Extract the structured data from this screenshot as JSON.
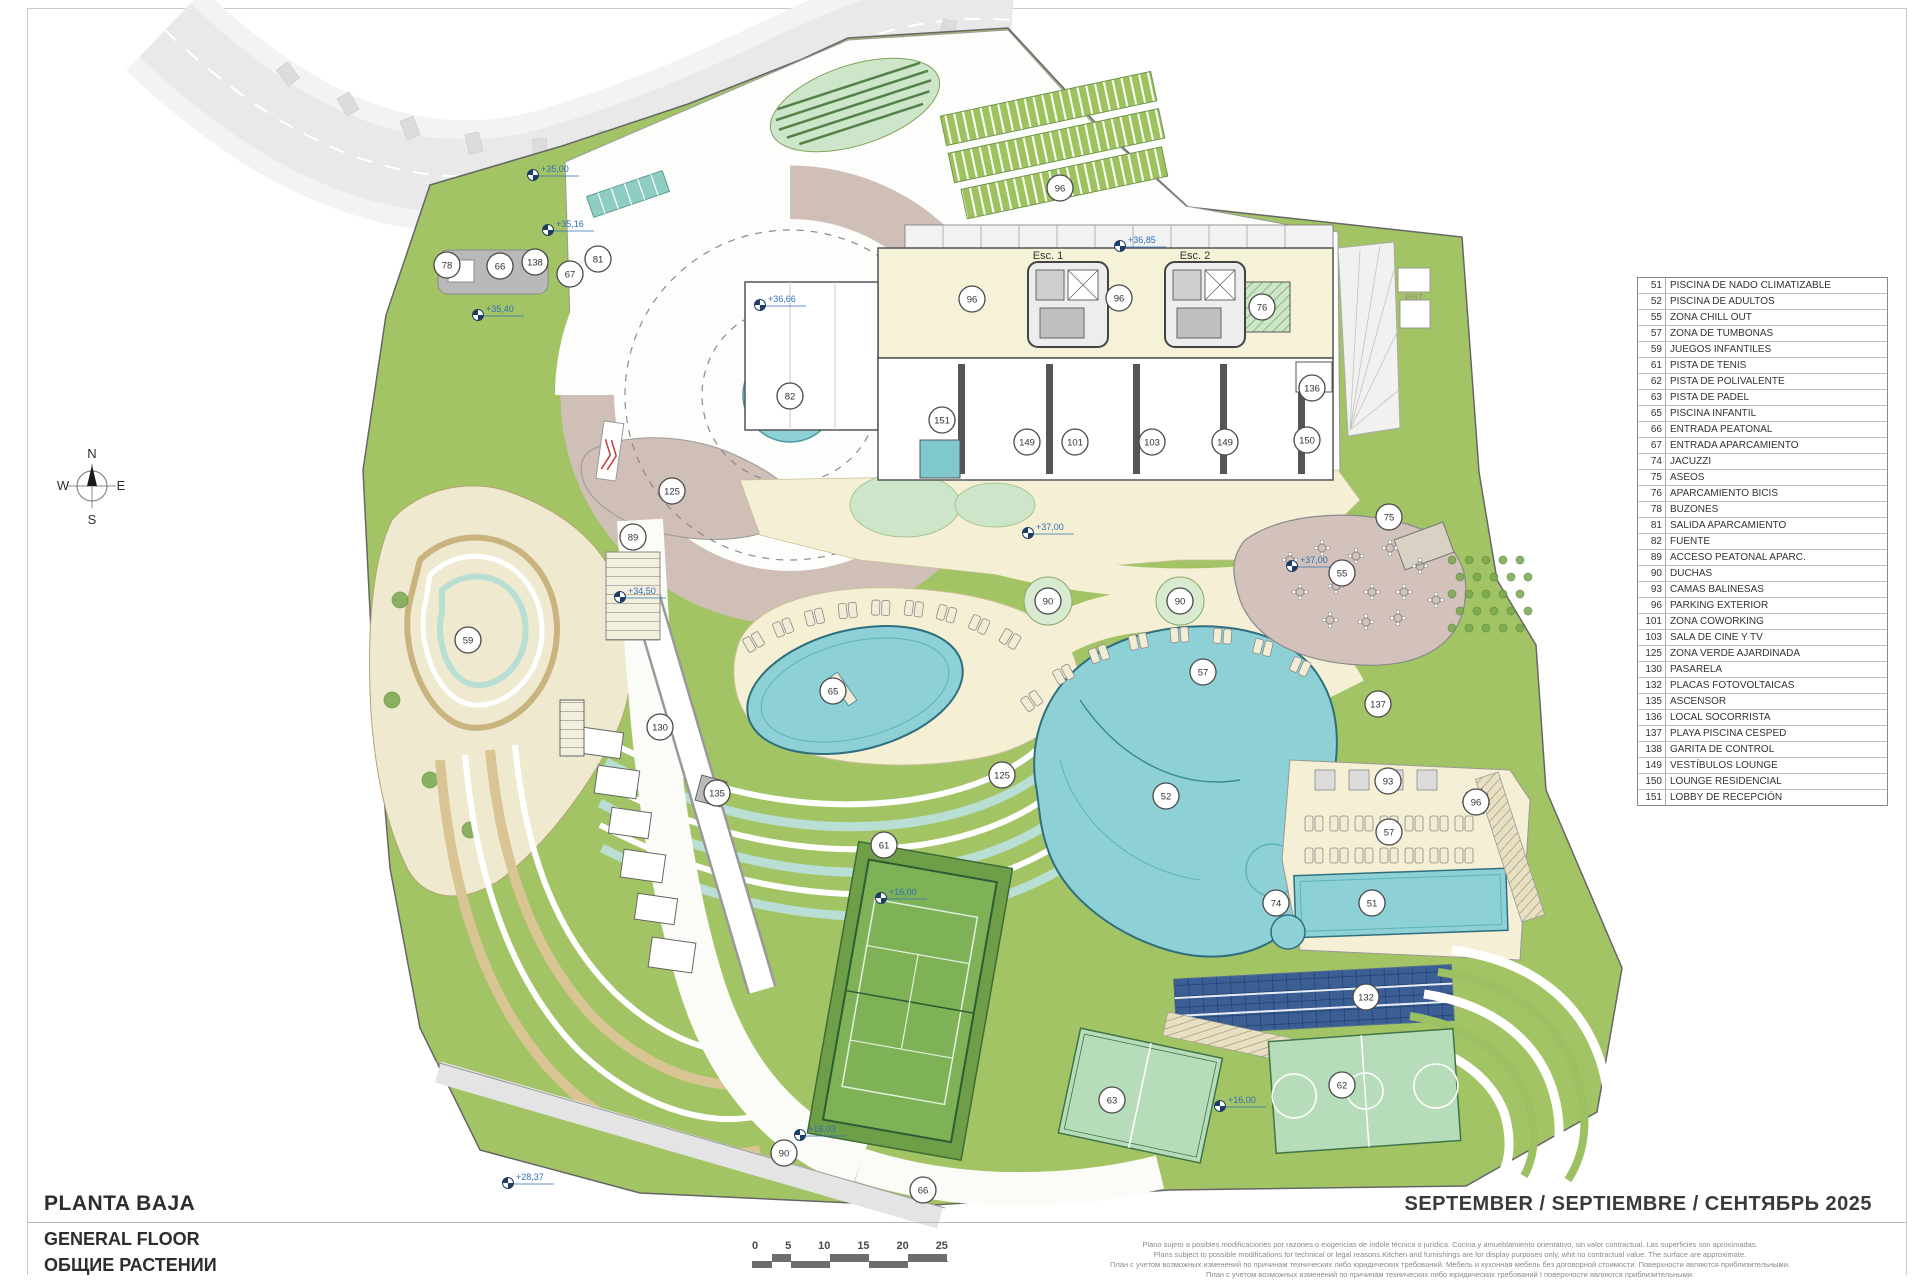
{
  "title_block": {
    "title_es": "PLANTA BAJA",
    "title_en": "GENERAL FLOOR",
    "title_ru": "ОБЩИЕ РАСТЕНИИ"
  },
  "date_line": "SEPTEMBER / SEPTIEMBRE / СЕНТЯБРЬ 2025",
  "compass": {
    "n": "N",
    "e": "E",
    "s": "S",
    "w": "W"
  },
  "colors": {
    "site_green": "#a3c465",
    "pool_blue": "#8dd0d6",
    "paved_mauve": "#cfbfb7",
    "beach_cream": "#f5f0d5",
    "solar_blue": "#3b5e94",
    "elevation_blue": "#2f6fb5",
    "road_gray": "#e9e9e9"
  },
  "map": {
    "road_label": "AVDA. DE MÉXICO",
    "pist_label": "PIST",
    "esc1_label": "Esc. 1",
    "esc2_label": "Esc. 2",
    "markers": [
      {
        "n": "78",
        "x": 447,
        "y": 265
      },
      {
        "n": "66",
        "x": 500,
        "y": 266
      },
      {
        "n": "138",
        "x": 535,
        "y": 262
      },
      {
        "n": "67",
        "x": 570,
        "y": 274
      },
      {
        "n": "81",
        "x": 598,
        "y": 259
      },
      {
        "n": "96",
        "x": 1060,
        "y": 188
      },
      {
        "n": "96",
        "x": 972,
        "y": 299
      },
      {
        "n": "96",
        "x": 1119,
        "y": 298
      },
      {
        "n": "76",
        "x": 1262,
        "y": 307
      },
      {
        "n": "82",
        "x": 790,
        "y": 396
      },
      {
        "n": "136",
        "x": 1312,
        "y": 388
      },
      {
        "n": "151",
        "x": 942,
        "y": 420
      },
      {
        "n": "149",
        "x": 1027,
        "y": 442
      },
      {
        "n": "101",
        "x": 1075,
        "y": 442
      },
      {
        "n": "103",
        "x": 1152,
        "y": 442
      },
      {
        "n": "149",
        "x": 1225,
        "y": 442
      },
      {
        "n": "150",
        "x": 1307,
        "y": 440
      },
      {
        "n": "125",
        "x": 672,
        "y": 491
      },
      {
        "n": "89",
        "x": 633,
        "y": 537
      },
      {
        "n": "75",
        "x": 1389,
        "y": 517
      },
      {
        "n": "55",
        "x": 1342,
        "y": 573
      },
      {
        "n": "90",
        "x": 1048,
        "y": 601
      },
      {
        "n": "90",
        "x": 1180,
        "y": 601
      },
      {
        "n": "57",
        "x": 1203,
        "y": 672
      },
      {
        "n": "65",
        "x": 833,
        "y": 691
      },
      {
        "n": "59",
        "x": 468,
        "y": 640
      },
      {
        "n": "137",
        "x": 1378,
        "y": 704
      },
      {
        "n": "93",
        "x": 1388,
        "y": 781
      },
      {
        "n": "96",
        "x": 1476,
        "y": 802
      },
      {
        "n": "57",
        "x": 1389,
        "y": 832
      },
      {
        "n": "52",
        "x": 1166,
        "y": 796
      },
      {
        "n": "125",
        "x": 1002,
        "y": 775
      },
      {
        "n": "74",
        "x": 1276,
        "y": 903
      },
      {
        "n": "51",
        "x": 1372,
        "y": 903
      },
      {
        "n": "61",
        "x": 884,
        "y": 845
      },
      {
        "n": "130",
        "x": 660,
        "y": 727
      },
      {
        "n": "135",
        "x": 717,
        "y": 793
      },
      {
        "n": "132",
        "x": 1366,
        "y": 997
      },
      {
        "n": "62",
        "x": 1342,
        "y": 1085
      },
      {
        "n": "63",
        "x": 1112,
        "y": 1100
      },
      {
        "n": "90",
        "x": 784,
        "y": 1153
      },
      {
        "n": "66",
        "x": 923,
        "y": 1190
      }
    ],
    "elevation_points": [
      {
        "label": "+35,00",
        "x": 533,
        "y": 175
      },
      {
        "label": "+35,16",
        "x": 548,
        "y": 230
      },
      {
        "label": "+35,40",
        "x": 478,
        "y": 315
      },
      {
        "label": "+36,66",
        "x": 760,
        "y": 305
      },
      {
        "label": "+36,85",
        "x": 1120,
        "y": 246
      },
      {
        "label": "+37,00",
        "x": 1028,
        "y": 533
      },
      {
        "label": "+37,00",
        "x": 1292,
        "y": 566
      },
      {
        "label": "+34,50",
        "x": 620,
        "y": 597
      },
      {
        "label": "+16,00",
        "x": 881,
        "y": 898
      },
      {
        "label": "+16,00",
        "x": 1220,
        "y": 1106
      },
      {
        "label": "+16,03",
        "x": 800,
        "y": 1135
      },
      {
        "label": "+28,37",
        "x": 508,
        "y": 1183
      }
    ]
  },
  "legend": {
    "items": [
      {
        "num": "51",
        "label": "PISCINA DE NADO CLIMATIZABLE"
      },
      {
        "num": "52",
        "label": "PISCINA DE ADULTOS"
      },
      {
        "num": "55",
        "label": "ZONA CHILL OUT"
      },
      {
        "num": "57",
        "label": "ZONA DE TUMBONAS"
      },
      {
        "num": "59",
        "label": "JUEGOS INFANTILES"
      },
      {
        "num": "61",
        "label": "PISTA DE TENIS"
      },
      {
        "num": "62",
        "label": "PISTA DE POLIVALENTE"
      },
      {
        "num": "63",
        "label": "PISTA DE PADEL"
      },
      {
        "num": "65",
        "label": "PISCINA INFANTIL"
      },
      {
        "num": "66",
        "label": "ENTRADA PEATONAL"
      },
      {
        "num": "67",
        "label": "ENTRADA APARCAMIENTO"
      },
      {
        "num": "74",
        "label": "JACUZZI"
      },
      {
        "num": "75",
        "label": "ASEOS"
      },
      {
        "num": "76",
        "label": "APARCAMIENTO BICIS"
      },
      {
        "num": "78",
        "label": "BUZONES"
      },
      {
        "num": "81",
        "label": "SALIDA APARCAMIENTO"
      },
      {
        "num": "82",
        "label": "FUENTE"
      },
      {
        "num": "89",
        "label": "ACCESO PEATONAL APARC."
      },
      {
        "num": "90",
        "label": "DUCHAS"
      },
      {
        "num": "93",
        "label": "CAMAS BALINESAS"
      },
      {
        "num": "96",
        "label": "PARKING EXTERIOR"
      },
      {
        "num": "101",
        "label": "ZONA COWORKING"
      },
      {
        "num": "103",
        "label": "SALA DE CINE Y TV"
      },
      {
        "num": "125",
        "label": "ZONA VERDE AJARDINADA"
      },
      {
        "num": "130",
        "label": "PASARELA"
      },
      {
        "num": "132",
        "label": "PLACAS FOTOVOLTAICAS"
      },
      {
        "num": "135",
        "label": "ASCENSOR"
      },
      {
        "num": "136",
        "label": "LOCAL SOCORRISTA"
      },
      {
        "num": "137",
        "label": "PLAYA PISCINA CESPED"
      },
      {
        "num": "138",
        "label": "GARITA DE CONTROL"
      },
      {
        "num": "149",
        "label": "VESTÍBULOS LOUNGE"
      },
      {
        "num": "150",
        "label": "LOUNGE RESIDENCIAL"
      },
      {
        "num": "151",
        "label": "LOBBY DE RECEPCIÓN"
      }
    ]
  },
  "scale_bar": {
    "ticks": [
      "0",
      "5",
      "10",
      "15",
      "20",
      "25"
    ]
  },
  "disclaimer_lines": [
    "Plano sujeto a posibles modificaciones por razones o exigencias de índole técnica o jurídica. Cocina y amueblamiento orientativo, sin valor contractual. Las superficies son aproximadas.",
    "Plans subject to possible modifications for technical or legal reasons.Kitchen and furnishings are for display purposes only, whit no contractual value. The surface are approximate.",
    "План с учетом возможных изменений по причинам технических либо юридических требований. Мебель и кухонная мебель без договорной стоимости. Поверхности являются приблизительными.",
    "План с учетом возможных изменений по причинам технических либо юридических требований I поверхности являются приблизительными."
  ]
}
